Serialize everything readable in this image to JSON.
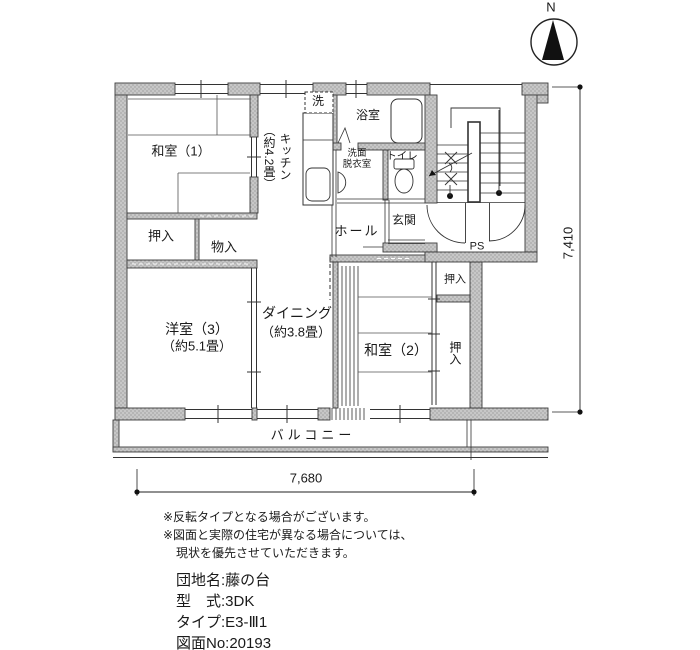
{
  "compass": {
    "label": "N"
  },
  "rooms": {
    "washitsu1": "和室（1）",
    "oshiire1": "押入",
    "monoire": "物入",
    "kitchen_name": "キッチン",
    "kitchen_size": "（約4.2畳）",
    "washer": "洗",
    "bath": "浴室",
    "senmen_line1": "洗面",
    "senmen_line2": "脱衣室",
    "toilet": "トイレ",
    "genkan": "玄関",
    "hall": "ホール",
    "ps": "PS",
    "yoshitsu3": "洋室（3）",
    "yoshitsu3_size": "（約5.1畳）",
    "dining": "ダイニング",
    "dining_size": "（約3.8畳）",
    "washitsu2": "和室（2）",
    "oshiire2": "押入",
    "oshiire3": "押入",
    "balcony": "バルコニー"
  },
  "dimensions": {
    "vertical": "7,410",
    "horizontal": "7,680"
  },
  "notes": [
    "※反転タイプとなる場合がございます。",
    "※図面と実際の住宅が異なる場合については、",
    "現状を優先させていただきます。"
  ],
  "specs": [
    "団地名:藤の台",
    "型　式:3DK",
    "タイプ:E3-Ⅲ1",
    "図面No:20193"
  ],
  "colors": {
    "ink": "#1a1a1a",
    "wall_fill": "#c7c7c7",
    "wall_stipple": "#8f8f8f"
  }
}
